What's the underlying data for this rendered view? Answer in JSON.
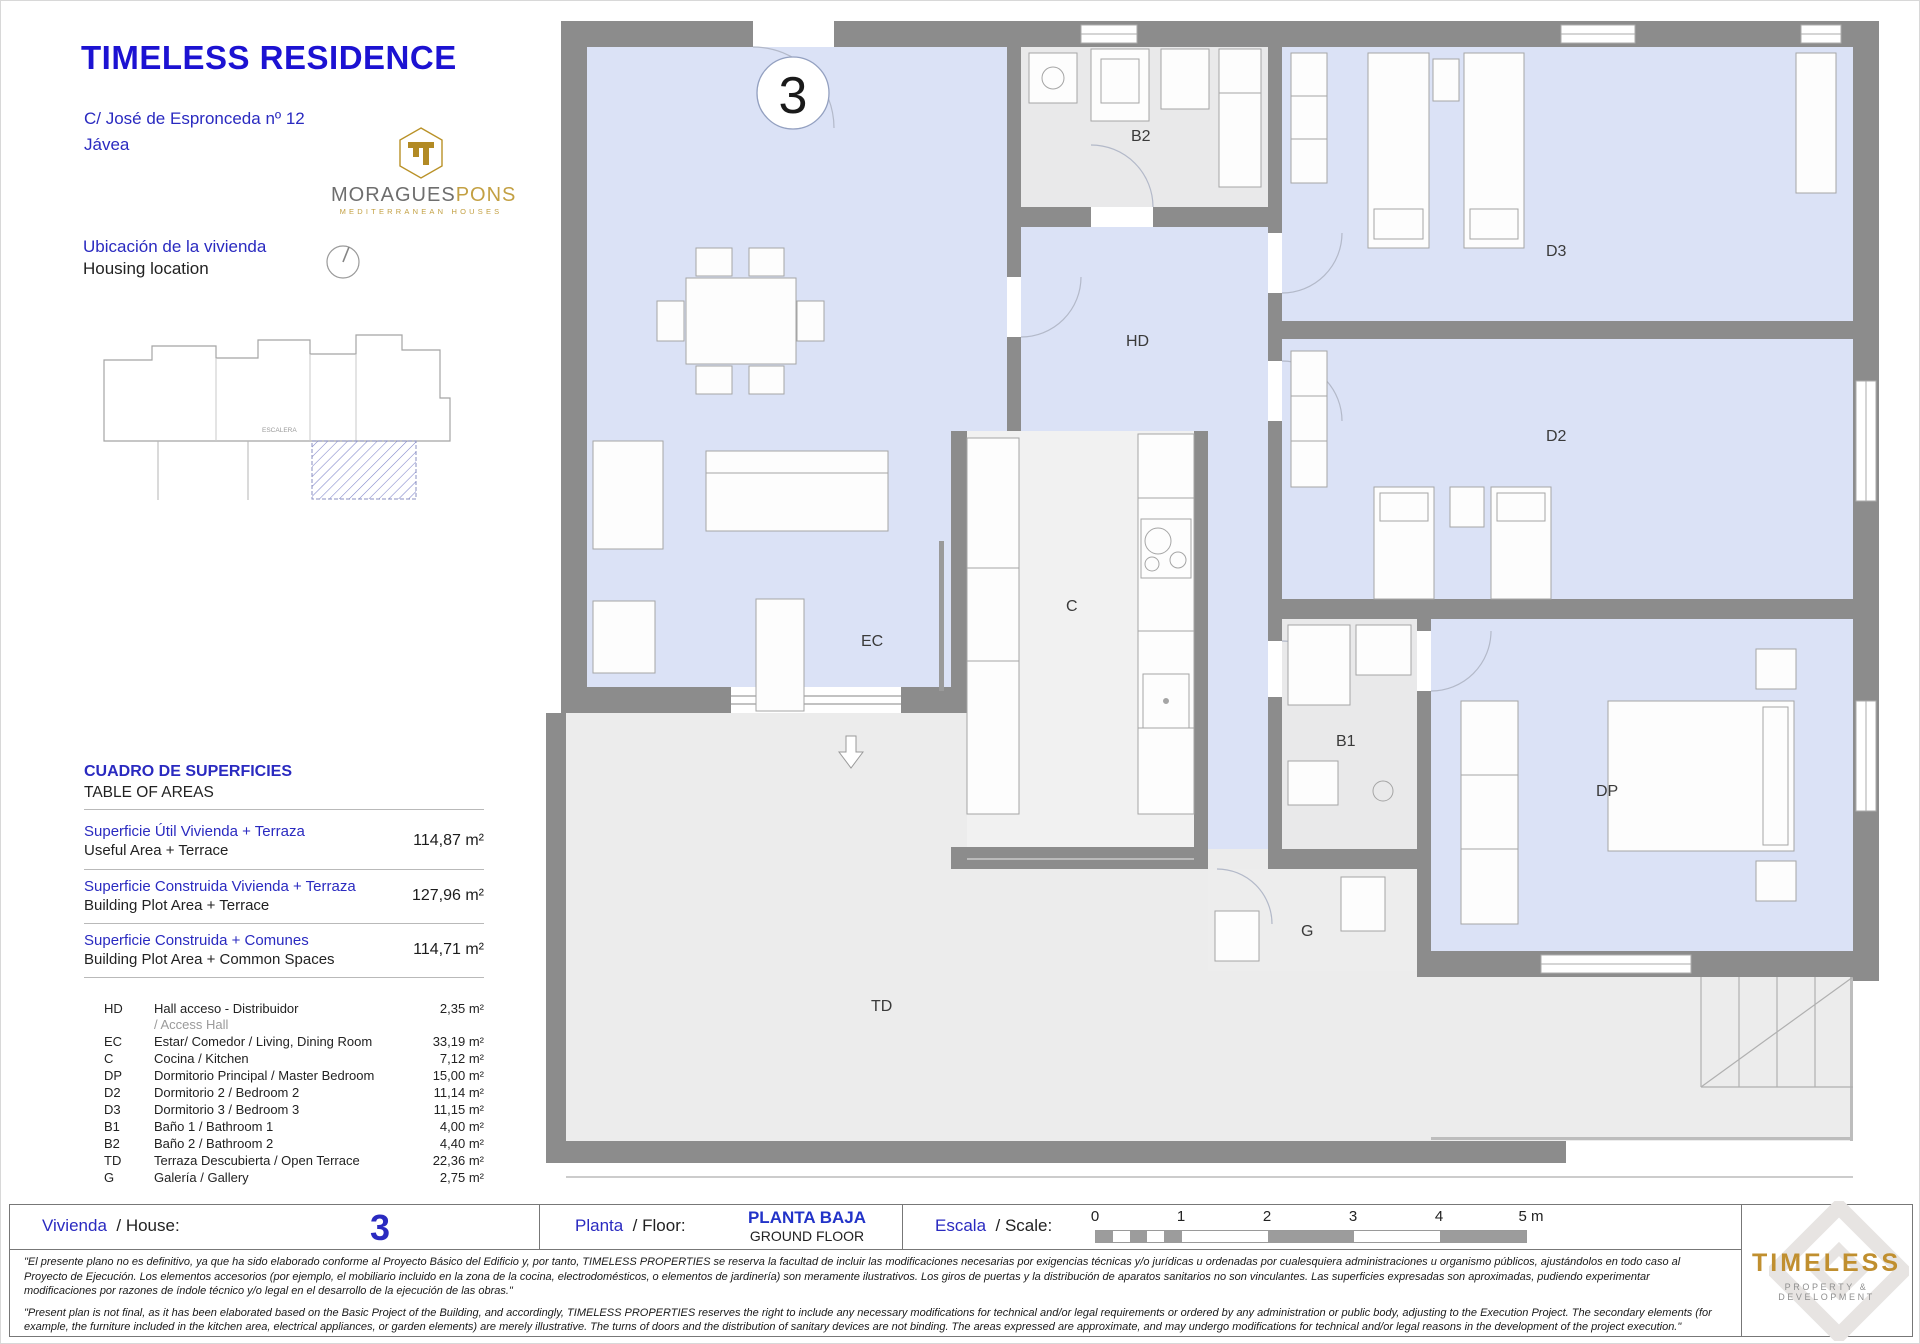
{
  "header": {
    "title": "TIMELESS RESIDENCE",
    "address_line1": "C/ José de Espronceda nº 12",
    "address_line2": "Jávea"
  },
  "brand": {
    "name_primary": "MORAGUES",
    "name_secondary": "PONS",
    "tagline": "MEDITERRANEAN HOUSES"
  },
  "location": {
    "label_es": "Ubicación de la vivienda",
    "label_en": "Housing location",
    "stairs_label": "ESCALERA"
  },
  "areas": {
    "heading_es": "CUADRO DE SUPERFICIES",
    "heading_en": "TABLE OF AREAS",
    "summary": [
      {
        "label_es": "Superficie Útil Vivienda + Terraza",
        "label_en": "Useful Area + Terrace",
        "value": "114,87 m²"
      },
      {
        "label_es": "Superficie Construida Vivienda + Terraza",
        "label_en": "Building Plot Area + Terrace",
        "value": "127,96 m²"
      },
      {
        "label_es": "Superficie Construida + Comunes",
        "label_en": "Building Plot Area + Common Spaces",
        "value": "114,71 m²"
      }
    ],
    "rooms": [
      {
        "code": "HD",
        "name": "Hall acceso - Distribuidor",
        "name2": "/ Access Hall",
        "value": "2,35 m²"
      },
      {
        "code": "EC",
        "name": "Estar/ Comedor  / Living, Dining Room",
        "value": "33,19 m²"
      },
      {
        "code": "C",
        "name": "Cocina   / Kitchen",
        "value": "7,12 m²"
      },
      {
        "code": "DP",
        "name": "Dormitorio Principal   / Master Bedroom",
        "value": "15,00 m²"
      },
      {
        "code": "D2",
        "name": "Dormitorio 2   / Bedroom 2",
        "value": "11,14 m²"
      },
      {
        "code": "D3",
        "name": "Dormitorio 3   / Bedroom 3",
        "value": "11,15 m²"
      },
      {
        "code": "B1",
        "name": "Baño 1   / Bathroom 1",
        "value": "4,00 m²"
      },
      {
        "code": "B2",
        "name": "Baño 2   / Bathroom 2",
        "value": "4,40 m²"
      },
      {
        "code": "TD",
        "name": "Terraza Descubierta   / Open Terrace",
        "value": "22,36 m²"
      },
      {
        "code": "G",
        "name": "Galería   / Gallery",
        "value": "2,75 m²"
      }
    ]
  },
  "plan": {
    "unit": "3",
    "labels": {
      "ec": "EC",
      "c": "C",
      "hd": "HD",
      "dp": "DP",
      "d2": "D2",
      "d3": "D3",
      "b1": "B1",
      "b2": "B2",
      "td": "TD",
      "g": "G"
    }
  },
  "footer": {
    "house_label_es": "Vivienda",
    "house_label_rest": "/ House:",
    "house_number": "3",
    "floor_label_es": "Planta",
    "floor_label_rest": "/ Floor:",
    "floor_value_es": "PLANTA BAJA",
    "floor_value_en": "GROUND FLOOR",
    "scale_label_es": "Escala",
    "scale_label_rest": "/ Scale:",
    "scale_ticks": [
      "0",
      "1",
      "2",
      "3",
      "4",
      "5 m"
    ],
    "disclaimer_es": "\"El presente plano no es definitivo, ya que ha sido elaborado conforme al Proyecto Básico del Edificio y, por tanto, TIMELESS PROPERTIES se reserva la facultad de incluir las modificaciones necesarias por exigencias técnicas y/o jurídicas u ordenadas por cualesquiera administraciones u organismo públicos, ajustándolos en todo caso al Proyecto de Ejecución. Los elementos accesorios (por ejemplo, el mobiliario incluido en la zona de la cocina, electrodomésticos, o elementos de jardinería) son meramente ilustrativos. Los giros de puertas y la distribución de aparatos sanitarios no son vinculantes. Las superficies expresadas son aproximadas, pudiendo experimentar modificaciones por razones de índole técnico y/o legal en el desarrollo de la ejecución de las obras.\"",
    "disclaimer_en": "\"Present plan is not final, as it has been elaborated based on the Basic Project of the Building, and accordingly, TIMELESS PROPERTIES reserves the right to include any necessary modifications for technical and/or legal requirements or ordered by any administration or public body, adjusting to the Execution Project. The secondary elements (for example, the furniture included in the kitchen area, electrical appliances, or garden elements) are merely illustrative. The turns of doors and the distribution of sanitary devices are not binding. The areas expressed are approximate, and may undergo modifications for technical and/or legal reasons in the development of the project execution.\"",
    "logo_name": "TIMELESS",
    "logo_tagline": "PROPERTY & DEVELOPMENT"
  },
  "colors": {
    "accent_blue": "#2a2ac0",
    "brand_gold": "#c3a043",
    "wall_gray": "#8c8c8c",
    "floor_blue": "#dbe2f6"
  }
}
